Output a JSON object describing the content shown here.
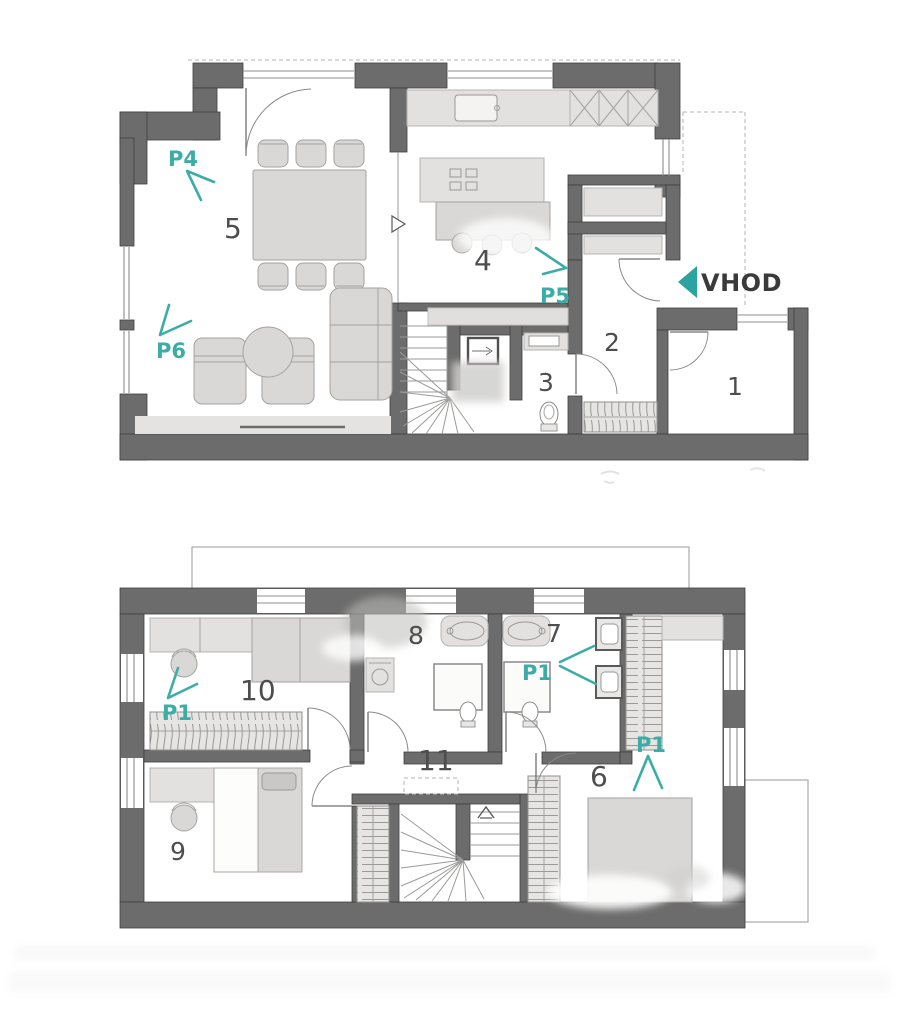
{
  "floor_upper": {
    "rooms": {
      "r1": "1",
      "r2": "2",
      "r3": "3",
      "r4": "4",
      "r5": "5"
    },
    "markers": {
      "p4": "P4",
      "p5": "P5",
      "p6": "P6"
    },
    "entrance": "VHOD"
  },
  "floor_lower": {
    "rooms": {
      "r6": "6",
      "r7": "7",
      "r8": "8",
      "r9": "9",
      "r10": "10",
      "r11": "11"
    },
    "markers": {
      "p1_bedroom10": "P1",
      "p1_bathroom7": "P1",
      "p1_bedroom6": "P1"
    }
  },
  "colors": {
    "wall": "#6c6c6c",
    "teal_accent": "#3bada6",
    "furniture": "#d9d8d6",
    "counter": "#e2e1df",
    "room_number_text": "#4d4d4d",
    "entrance_text": "#3a3a3a"
  }
}
